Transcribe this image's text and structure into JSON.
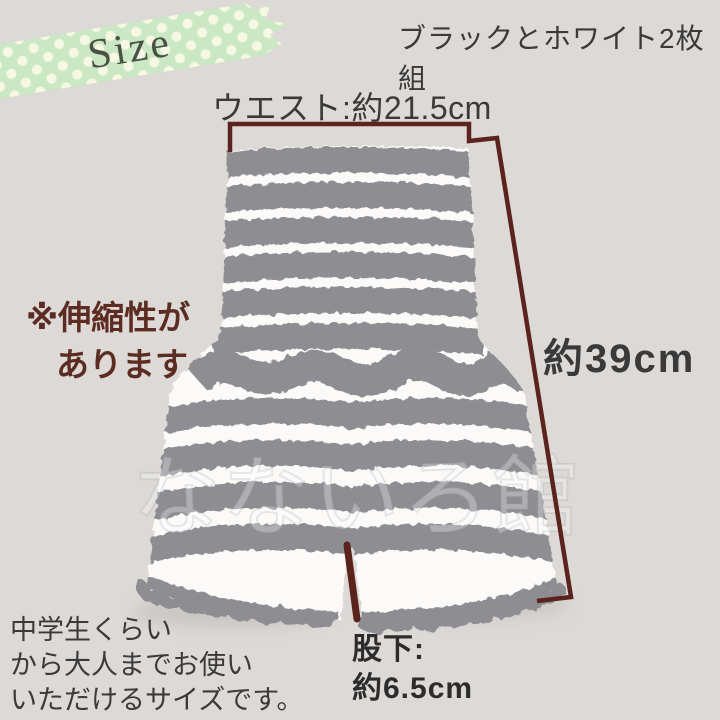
{
  "colors": {
    "bg": "#dcd9d6",
    "stripe-gray": "#8d8d92",
    "stripe-white": "#fbfaf9",
    "measure": "#5a231c",
    "maroon-text": "#5c2b21",
    "dark-text": "#3a3a3a",
    "tape-green": "#cbe8c4",
    "tape-dot": "#f6f8e3",
    "tape-text": "#4b5146",
    "watermark": "#ffffff"
  },
  "badge": {
    "label": "Size"
  },
  "header": {
    "subtitle": "ブラックとホワイト2枚組"
  },
  "measurements": {
    "waist_label": "ウエスト:約21.5cm",
    "length_label": "約39cm",
    "inseam_label_line1": "股下:",
    "inseam_label_line2": "約6.5cm"
  },
  "notes": {
    "stretch_line1": "※伸縮性が",
    "stretch_line2": "あります",
    "size_line1": "中学生くらい",
    "size_line2": "から大人までお使い",
    "size_line3": "いただけるサイズです。"
  },
  "watermark": {
    "text": "なないろ館"
  }
}
